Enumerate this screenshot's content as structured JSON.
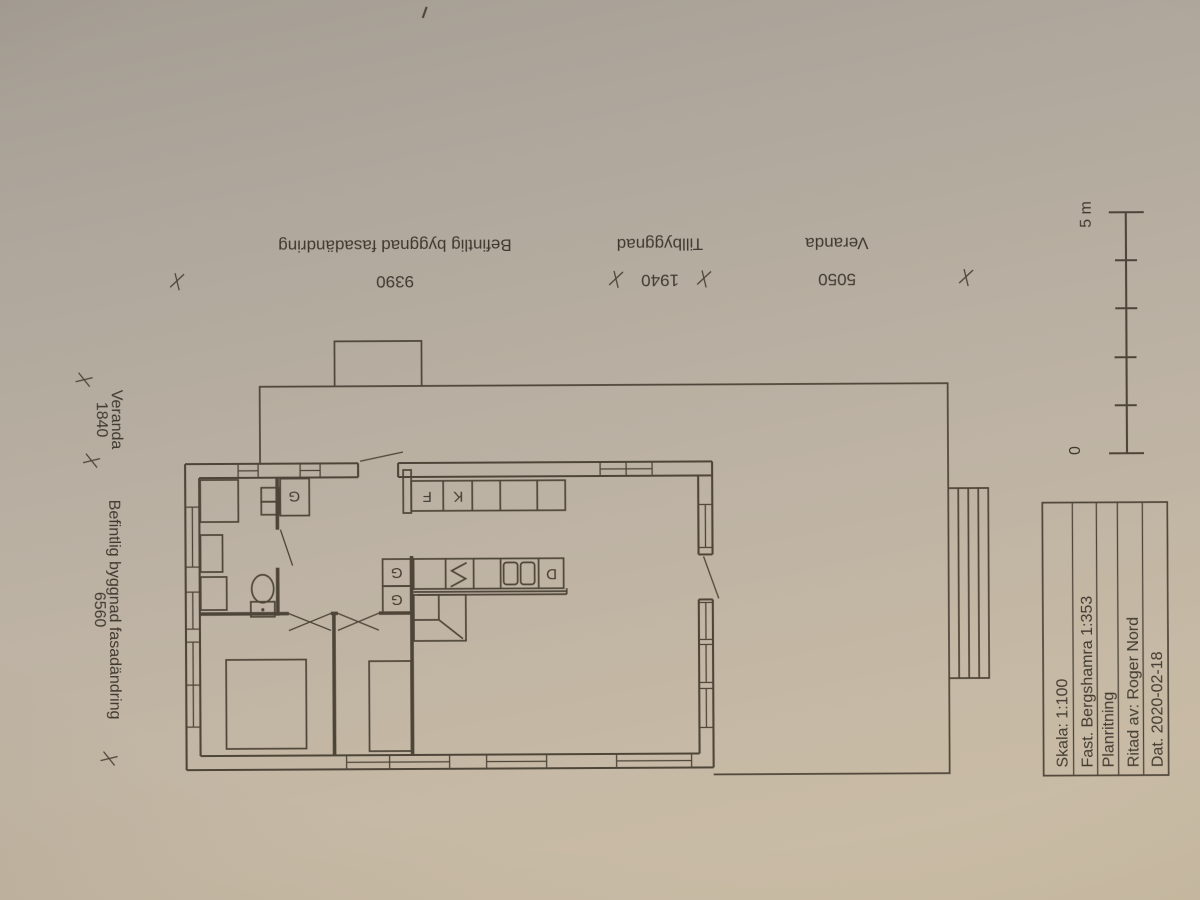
{
  "colors": {
    "ink": "#453c30",
    "paper_top": "#a49d93",
    "paper_bottom": "#ccbea5"
  },
  "dimensions_top": {
    "segments": [
      {
        "label": "Befintlig byggnad fasadändring",
        "value": "9390"
      },
      {
        "label": "Tillbyggnad",
        "value": "1940"
      },
      {
        "label": "Veranda",
        "value": "5050"
      }
    ]
  },
  "dimensions_left": {
    "veranda": {
      "value": "1840",
      "label": "Veranda"
    },
    "building": {
      "value": "6560",
      "label": "Befintlig byggnad fasadändring"
    }
  },
  "scale_bar": {
    "max": "5 m",
    "min": "0"
  },
  "plan_labels": {
    "closet": "G",
    "fridge": "K",
    "freezer": "F",
    "dishwasher": "D"
  },
  "title_block": {
    "scale": "Skala: 1:100",
    "property": "Fast. Bergshamra 1:353",
    "drawing_type": "Planritning",
    "author": "Ritad av: Roger Nord",
    "date": "Dat. 2020-02-18"
  }
}
